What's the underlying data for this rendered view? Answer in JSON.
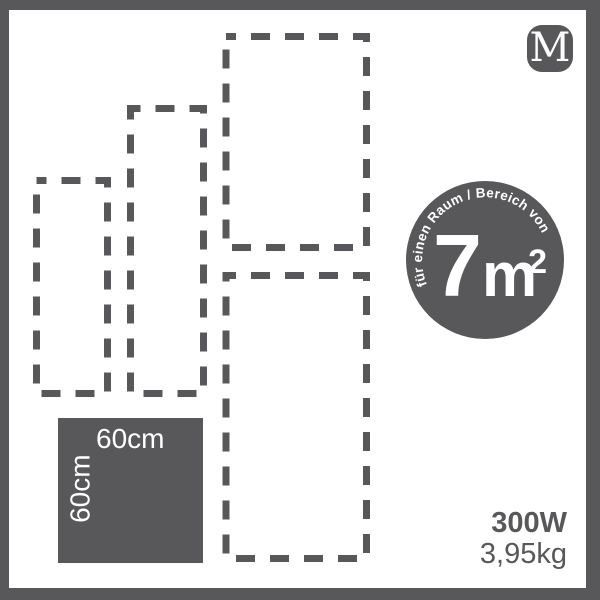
{
  "theme": {
    "ink": "#58585a",
    "bg": "#ffffff",
    "text_on_ink": "#ffffff"
  },
  "logo": {
    "letter": "M"
  },
  "badge": {
    "arc_text": "für einen Raum / Bereich von",
    "area_value": "7",
    "area_unit": "m",
    "area_exponent": "2"
  },
  "panel": {
    "width_label": "60cm",
    "height_label": "60cm"
  },
  "specs": {
    "power": "300W",
    "weight": "3,95kg"
  },
  "size_outlines": [
    {
      "name": "small",
      "x": 36.5,
      "y": 180.5,
      "w": 71,
      "h": 213
    },
    {
      "name": "medium",
      "x": 130.5,
      "y": 108.5,
      "w": 73,
      "h": 285
    },
    {
      "name": "tall-top",
      "x": 226,
      "y": 36.5,
      "w": 140.5,
      "h": 211
    },
    {
      "name": "tall-bottom",
      "x": 226,
      "y": 275.5,
      "w": 140.5,
      "h": 283
    }
  ],
  "outline_style": {
    "stroke": "#58585a",
    "stroke_width": 7,
    "dash": "19 15",
    "dashoffset": 9
  }
}
